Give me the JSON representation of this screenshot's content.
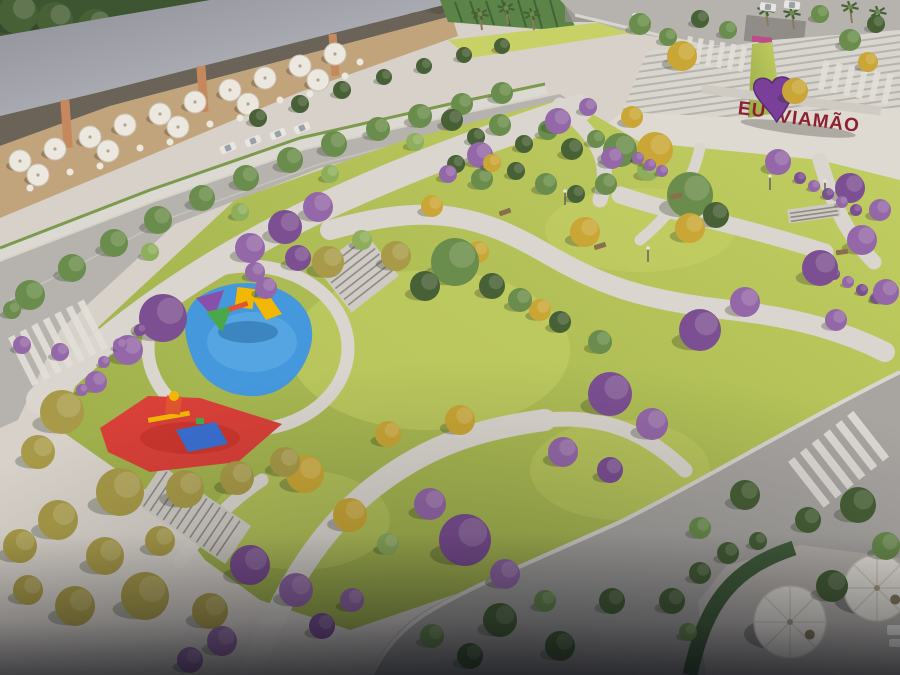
{
  "scene_label": "aerial-render-urban-park",
  "sign": {
    "prefix": "EU",
    "suffix": "VIAMÃO",
    "heart_icon": "heart"
  },
  "colors": {
    "pavement": "#d7d1c9",
    "plaza": "#ded9d1",
    "path": "#dad5ce",
    "curb": "#d8d4ce",
    "lawn": "#aebd54",
    "lawn_light": "#c7d166",
    "lawn_dark": "#94a847",
    "road": "#b6b3af",
    "road_dark": "#a8a5a1",
    "roof_dark": "#8e8f97",
    "roof_light": "#c2c4ca",
    "facade": "#5f554b",
    "column": "#c5895d",
    "terrace_floor": "#c2a47c",
    "canopy": "#dcd8d2",
    "canopy_green": "#7c9a4c",
    "umbrella": "#ece8df",
    "forest": "#3d5531",
    "tree_green": "#6a8c4c",
    "tree_dark": "#476036",
    "tree_light": "#8fae5c",
    "tree_olive": "#a89a48",
    "tree_yellow": "#c9a635",
    "tree_purple": "#9468a8",
    "tree_purple_deep": "#7c4f92",
    "hedge": "#44603c",
    "steps": "#d9d5cf",
    "steps_line": "#b7b3ad",
    "wall_green": "#5d8448",
    "shelter": "#908d89",
    "shelter_accent": "#c04a8a",
    "playground_blue": "#4598dc",
    "playground_blue_light": "#63b2e6",
    "playground_red": "#d84038",
    "playground_red_dark": "#c23028",
    "equip_yellow": "#f2b705",
    "equip_red": "#e05530",
    "equip_blue": "#3a6fd0",
    "equip_green": "#4aa84a",
    "equip_purple": "#8a4fa8",
    "sign_letters": "#8e2130",
    "sign_heart": "#7a3f98",
    "sign_heart_dark": "#5a2d73",
    "trunk": "#8a7a5c",
    "bench": "#8a6f4d",
    "car": "#e8e6e2",
    "lamp": "#6b665f"
  },
  "scene": {
    "trees_back": [
      [
        18,
        14,
        20,
        "d"
      ],
      [
        55,
        20,
        18,
        "d"
      ],
      [
        95,
        26,
        17,
        "d"
      ],
      [
        135,
        28,
        15,
        "d"
      ],
      [
        172,
        26,
        14,
        "d"
      ],
      [
        208,
        20,
        13,
        "d"
      ],
      [
        242,
        14,
        13,
        "d"
      ],
      [
        276,
        10,
        12,
        "d"
      ],
      [
        310,
        8,
        12,
        "d"
      ],
      [
        344,
        6,
        11,
        "d"
      ],
      [
        378,
        4,
        11,
        "d"
      ],
      [
        410,
        4,
        10,
        "d"
      ],
      [
        438,
        4,
        10,
        "d"
      ]
    ],
    "trees": [
      [
        30,
        295,
        15,
        "g"
      ],
      [
        72,
        268,
        14,
        "g"
      ],
      [
        114,
        243,
        14,
        "g"
      ],
      [
        158,
        220,
        14,
        "g"
      ],
      [
        202,
        198,
        13,
        "g"
      ],
      [
        246,
        178,
        13,
        "g"
      ],
      [
        290,
        160,
        13,
        "g"
      ],
      [
        334,
        144,
        13,
        "g"
      ],
      [
        378,
        129,
        12,
        "g"
      ],
      [
        420,
        116,
        12,
        "g"
      ],
      [
        462,
        104,
        11,
        "g"
      ],
      [
        502,
        93,
        11,
        "g"
      ],
      [
        150,
        252,
        9,
        "l"
      ],
      [
        240,
        212,
        9,
        "l"
      ],
      [
        330,
        174,
        9,
        "l"
      ],
      [
        415,
        142,
        9,
        "l"
      ],
      [
        258,
        118,
        9,
        "d"
      ],
      [
        300,
        104,
        9,
        "d"
      ],
      [
        342,
        90,
        9,
        "d"
      ],
      [
        384,
        77,
        8,
        "d"
      ],
      [
        424,
        66,
        8,
        "d"
      ],
      [
        464,
        55,
        8,
        "d"
      ],
      [
        502,
        46,
        8,
        "d"
      ],
      [
        250,
        248,
        15,
        "p"
      ],
      [
        285,
        227,
        17,
        "P"
      ],
      [
        318,
        207,
        15,
        "p"
      ],
      [
        298,
        258,
        13,
        "P"
      ],
      [
        266,
        288,
        11,
        "p"
      ],
      [
        255,
        272,
        10,
        "p"
      ],
      [
        163,
        318,
        24,
        "P"
      ],
      [
        128,
        350,
        15,
        "p"
      ],
      [
        96,
        382,
        11,
        "p"
      ],
      [
        60,
        352,
        9,
        "p"
      ],
      [
        328,
        262,
        16,
        "o"
      ],
      [
        396,
        256,
        15,
        "o"
      ],
      [
        362,
        240,
        10,
        "l"
      ],
      [
        452,
        120,
        11,
        "d"
      ],
      [
        476,
        137,
        9,
        "d"
      ],
      [
        500,
        125,
        11,
        "g"
      ],
      [
        524,
        144,
        9,
        "d"
      ],
      [
        548,
        130,
        10,
        "g"
      ],
      [
        572,
        149,
        11,
        "d"
      ],
      [
        596,
        139,
        9,
        "g"
      ],
      [
        456,
        164,
        9,
        "d"
      ],
      [
        482,
        179,
        11,
        "g"
      ],
      [
        516,
        171,
        9,
        "d"
      ],
      [
        546,
        184,
        11,
        "g"
      ],
      [
        576,
        194,
        9,
        "d"
      ],
      [
        606,
        184,
        11,
        "g"
      ],
      [
        620,
        150,
        17,
        "g"
      ],
      [
        648,
        170,
        11,
        "l"
      ],
      [
        690,
        195,
        23,
        "g"
      ],
      [
        716,
        215,
        13,
        "d"
      ],
      [
        558,
        121,
        13,
        "p"
      ],
      [
        588,
        107,
        9,
        "p"
      ],
      [
        612,
        158,
        11,
        "p"
      ],
      [
        480,
        155,
        13,
        "p"
      ],
      [
        448,
        174,
        9,
        "p"
      ],
      [
        492,
        163,
        9,
        "y"
      ],
      [
        655,
        150,
        18,
        "y"
      ],
      [
        632,
        117,
        11,
        "y"
      ],
      [
        682,
        56,
        15,
        "y"
      ],
      [
        795,
        91,
        13,
        "y"
      ],
      [
        585,
        232,
        15,
        "y"
      ],
      [
        690,
        228,
        15,
        "y"
      ],
      [
        540,
        310,
        11,
        "y"
      ],
      [
        478,
        252,
        11,
        "y"
      ],
      [
        432,
        206,
        11,
        "y"
      ],
      [
        868,
        62,
        10,
        "y"
      ],
      [
        640,
        24,
        11,
        "g"
      ],
      [
        668,
        37,
        9,
        "g"
      ],
      [
        700,
        19,
        9,
        "d"
      ],
      [
        728,
        30,
        9,
        "g"
      ],
      [
        850,
        40,
        11,
        "g"
      ],
      [
        876,
        24,
        9,
        "d"
      ],
      [
        820,
        14,
        9,
        "g"
      ],
      [
        778,
        162,
        13,
        "p"
      ],
      [
        850,
        188,
        15,
        "P"
      ],
      [
        880,
        210,
        11,
        "p"
      ],
      [
        800,
        178,
        6,
        "P"
      ],
      [
        814,
        186,
        6,
        "p"
      ],
      [
        828,
        194,
        6,
        "P"
      ],
      [
        842,
        202,
        6,
        "p"
      ],
      [
        856,
        210,
        6,
        "P"
      ],
      [
        820,
        266,
        6,
        "p"
      ],
      [
        834,
        274,
        6,
        "P"
      ],
      [
        848,
        282,
        6,
        "p"
      ],
      [
        862,
        290,
        6,
        "P"
      ],
      [
        876,
        298,
        6,
        "p"
      ],
      [
        638,
        158,
        6,
        "p"
      ],
      [
        650,
        165,
        6,
        "p"
      ],
      [
        662,
        171,
        6,
        "p"
      ],
      [
        700,
        330,
        21,
        "P"
      ],
      [
        745,
        302,
        15,
        "p"
      ],
      [
        820,
        268,
        18,
        "P"
      ],
      [
        862,
        240,
        15,
        "p"
      ],
      [
        886,
        292,
        13,
        "p"
      ],
      [
        836,
        320,
        11,
        "p"
      ],
      [
        455,
        262,
        24,
        "g"
      ],
      [
        425,
        286,
        15,
        "d"
      ],
      [
        492,
        286,
        13,
        "d"
      ],
      [
        520,
        300,
        12,
        "g"
      ],
      [
        560,
        322,
        11,
        "d"
      ],
      [
        600,
        342,
        12,
        "g"
      ],
      [
        610,
        394,
        22,
        "P"
      ],
      [
        652,
        424,
        16,
        "p"
      ],
      [
        563,
        452,
        15,
        "p"
      ],
      [
        610,
        470,
        13,
        "P"
      ],
      [
        430,
        504,
        16,
        "p"
      ],
      [
        465,
        540,
        26,
        "P"
      ],
      [
        505,
        574,
        15,
        "p"
      ],
      [
        305,
        474,
        19,
        "y"
      ],
      [
        350,
        515,
        17,
        "y"
      ],
      [
        388,
        544,
        11,
        "l"
      ],
      [
        460,
        420,
        15,
        "y"
      ],
      [
        388,
        434,
        13,
        "y"
      ],
      [
        62,
        412,
        22,
        "o"
      ],
      [
        38,
        452,
        17,
        "o"
      ],
      [
        120,
        492,
        24,
        "o"
      ],
      [
        185,
        489,
        19,
        "o"
      ],
      [
        237,
        478,
        17,
        "o"
      ],
      [
        285,
        462,
        15,
        "o"
      ],
      [
        58,
        520,
        20,
        "o"
      ],
      [
        20,
        546,
        17,
        "o"
      ],
      [
        105,
        556,
        19,
        "o"
      ],
      [
        160,
        541,
        15,
        "o"
      ],
      [
        145,
        596,
        24,
        "o"
      ],
      [
        75,
        606,
        20,
        "o"
      ],
      [
        210,
        611,
        18,
        "o"
      ],
      [
        28,
        590,
        15,
        "o"
      ],
      [
        250,
        565,
        20,
        "P"
      ],
      [
        296,
        590,
        17,
        "p"
      ],
      [
        222,
        641,
        15,
        "p"
      ],
      [
        322,
        626,
        13,
        "P"
      ],
      [
        190,
        660,
        13,
        "p"
      ],
      [
        352,
        600,
        12,
        "p"
      ],
      [
        500,
        620,
        17,
        "d"
      ],
      [
        560,
        646,
        15,
        "d"
      ],
      [
        612,
        601,
        13,
        "d"
      ],
      [
        470,
        656,
        13,
        "d"
      ],
      [
        545,
        601,
        11,
        "g"
      ],
      [
        432,
        636,
        12,
        "g"
      ],
      [
        745,
        495,
        15,
        "d"
      ],
      [
        700,
        528,
        11,
        "g"
      ],
      [
        808,
        520,
        13,
        "d"
      ],
      [
        858,
        505,
        18,
        "d"
      ],
      [
        886,
        546,
        14,
        "g"
      ],
      [
        832,
        586,
        16,
        "d"
      ],
      [
        672,
        601,
        13,
        "d"
      ],
      [
        700,
        573,
        11,
        "d"
      ],
      [
        728,
        553,
        11,
        "d"
      ],
      [
        758,
        541,
        9,
        "d"
      ],
      [
        688,
        632,
        9,
        "g"
      ],
      [
        22,
        345,
        9,
        "p"
      ],
      [
        12,
        310,
        9,
        "g"
      ],
      [
        120,
        345,
        7,
        "p"
      ],
      [
        140,
        330,
        6,
        "P"
      ],
      [
        104,
        362,
        6,
        "p"
      ],
      [
        82,
        390,
        6,
        "p"
      ]
    ],
    "palms": [
      [
        480,
        14
      ],
      [
        506,
        8
      ],
      [
        532,
        14
      ],
      [
        766,
        10
      ],
      [
        792,
        13
      ],
      [
        850,
        7
      ],
      [
        878,
        12
      ]
    ],
    "terrace_umbrellas": [
      [
        20,
        161
      ],
      [
        55,
        149
      ],
      [
        90,
        137
      ],
      [
        125,
        125
      ],
      [
        160,
        114
      ],
      [
        195,
        102
      ],
      [
        230,
        90
      ],
      [
        265,
        78
      ],
      [
        300,
        66
      ],
      [
        335,
        54
      ],
      [
        38,
        175
      ],
      [
        108,
        151
      ],
      [
        178,
        127
      ],
      [
        248,
        104
      ],
      [
        318,
        80
      ]
    ],
    "terrace_tables": [
      [
        70,
        172
      ],
      [
        140,
        148
      ],
      [
        210,
        124
      ],
      [
        280,
        100
      ],
      [
        345,
        76
      ],
      [
        30,
        188
      ],
      [
        100,
        166
      ],
      [
        170,
        142
      ],
      [
        240,
        118
      ],
      [
        310,
        94
      ],
      [
        360,
        62
      ]
    ],
    "patio_umbrellas": [
      [
        790,
        622,
        36
      ],
      [
        877,
        588,
        33
      ]
    ],
    "cars_top": [
      [
        768,
        7,
        8
      ],
      [
        792,
        5,
        8
      ],
      [
        640,
        18,
        10
      ]
    ],
    "cars_parked": [
      [
        228,
        148,
        -22
      ],
      [
        253,
        141,
        -22
      ],
      [
        278,
        134,
        -22
      ],
      [
        302,
        128,
        -22
      ]
    ],
    "benches": [
      [
        600,
        246,
        -18
      ],
      [
        676,
        196,
        -12
      ],
      [
        842,
        252,
        -8
      ],
      [
        505,
        212,
        -20
      ]
    ],
    "lamps": [
      [
        825,
        195
      ],
      [
        770,
        190
      ],
      [
        648,
        262
      ],
      [
        565,
        205
      ]
    ],
    "crosswalks": [
      {
        "x": 8,
        "y": 338,
        "a": -27,
        "n": 7,
        "w": 7,
        "len": 54,
        "gap": 13
      },
      {
        "x": 688,
        "y": 36,
        "a": 10,
        "n": 6,
        "w": 5,
        "len": 26,
        "gap": 11
      },
      {
        "x": 824,
        "y": 60,
        "a": 12,
        "n": 6,
        "w": 6,
        "len": 30,
        "gap": 13
      },
      {
        "x": 788,
        "y": 462,
        "a": -38,
        "n": 6,
        "w": 8,
        "len": 58,
        "gap": 15
      }
    ]
  }
}
